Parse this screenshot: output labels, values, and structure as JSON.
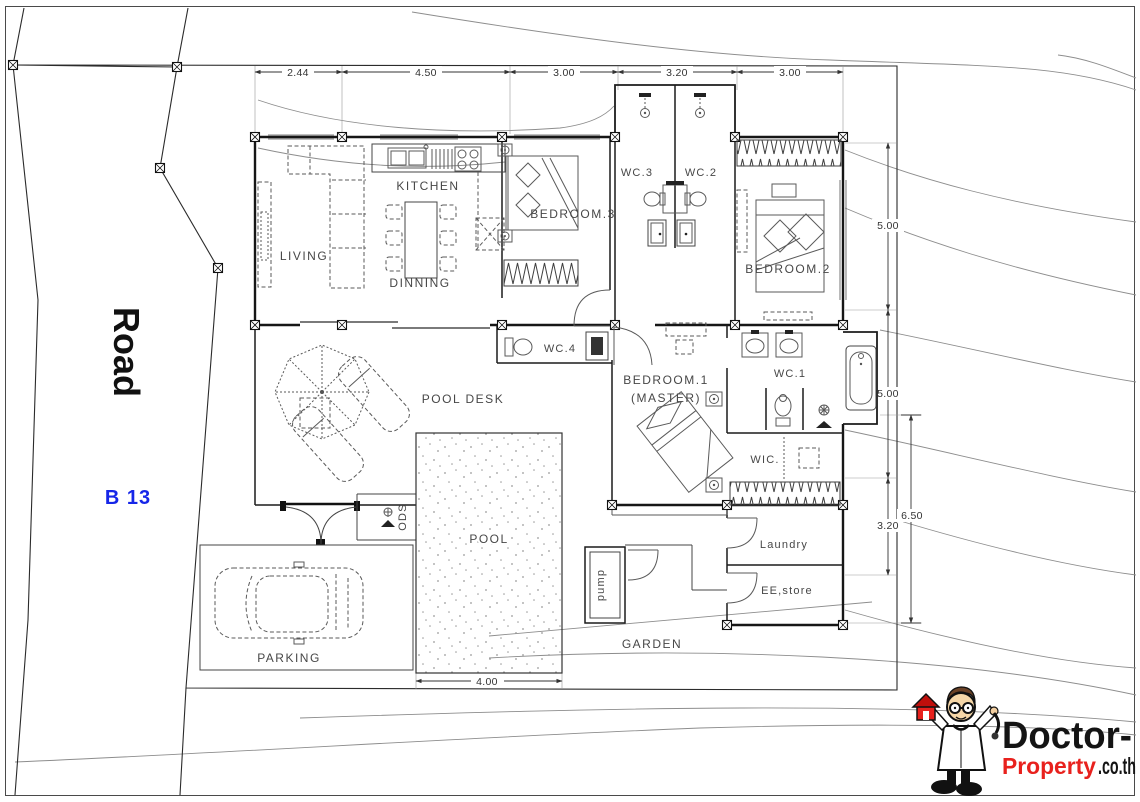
{
  "site": {
    "road_label": "Road",
    "plot_label": "B 13",
    "plot_label_color": "#1626e8"
  },
  "dimensions": {
    "top": [
      "2.44",
      "4.50",
      "3.00",
      "3.20",
      "3.00"
    ],
    "right_5a": "5.00",
    "right_5b": "5.00",
    "right_320": "3.20",
    "right_650": "6.50",
    "bottom_400": "4.00"
  },
  "rooms": {
    "living": "LIVING",
    "kitchen": "KITCHEN",
    "dinning": "DINNING",
    "bedroom3": "BEDROOM.3",
    "wc3": "WC.3",
    "wc2": "WC.2",
    "bedroom2": "BEDROOM.2",
    "wc4": "WC.4",
    "bedroom1_l1": "BEDROOM.1",
    "bedroom1_l2": "(MASTER)",
    "wc1": "WC.1",
    "wic": "WIC.",
    "pool_desk": "POOL DESK",
    "pool": "POOL",
    "pump": "pump",
    "ods": "ODS",
    "garden": "GARDEN",
    "parking": "PARKING",
    "laundry": "Laundry",
    "ee_store": "EE,store"
  },
  "logo": {
    "brand_black": "Doctor-",
    "brand_red": "Property",
    "brand_suffix": ".co.th",
    "accent_red": "#e8211d"
  }
}
